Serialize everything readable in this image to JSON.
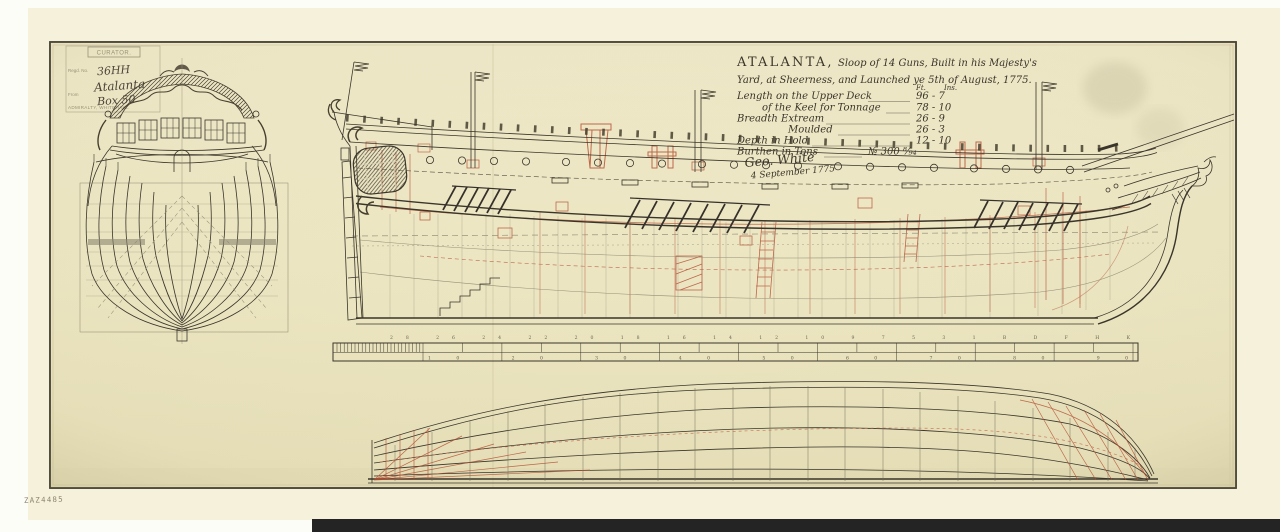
{
  "colors": {
    "sheet_paper": "#ece6c3",
    "backing_paper": "#f6f1da",
    "ink": "#3a352b",
    "red_ink": "#b2492e",
    "pencil": "#978f77",
    "border": "#3f3b2f",
    "bottom_bar": "#242424"
  },
  "stamp": {
    "header": "CURATOR.",
    "reg_label": "Regd. No.",
    "from_label": "From",
    "footer": "ADMIRALTY, WHITEHALL.",
    "number": "36HH",
    "ship_name": "Atalanta",
    "box": "Box 50"
  },
  "title_block": {
    "name": "ATALANTA,",
    "line1_rest": "Sloop of 14 Guns, Built in his Majesty's",
    "line2": "Yard, at Sheerness, and Launched ye 5th of August, 1775.",
    "col_ft": "Ft.",
    "col_in": "Ins.",
    "dimensions": [
      {
        "label": "Length on the Upper Deck",
        "value": "96 -  7"
      },
      {
        "label": "of the Keel for Tonnage",
        "value": "78 - 10"
      },
      {
        "label": "Breadth Extream",
        "value": "26 -  9"
      },
      {
        "label": "Moulded",
        "value": "26 -  3"
      },
      {
        "label": "Depth in Hold",
        "value": "12 - 10"
      },
      {
        "label": "Burthen in Tons",
        "value": "№ 300 ⁸⁄₉₄"
      }
    ],
    "signature": "Geo. White",
    "date": "4 September 1775"
  },
  "scale_bar": {
    "stations": "28 26 24 22 20 18 16 14 12 10 9 7 5 3 1 B D F H K",
    "feet": "10 20 30 40 50 60 70 80 90"
  },
  "plan_number": "ZAZ4485"
}
